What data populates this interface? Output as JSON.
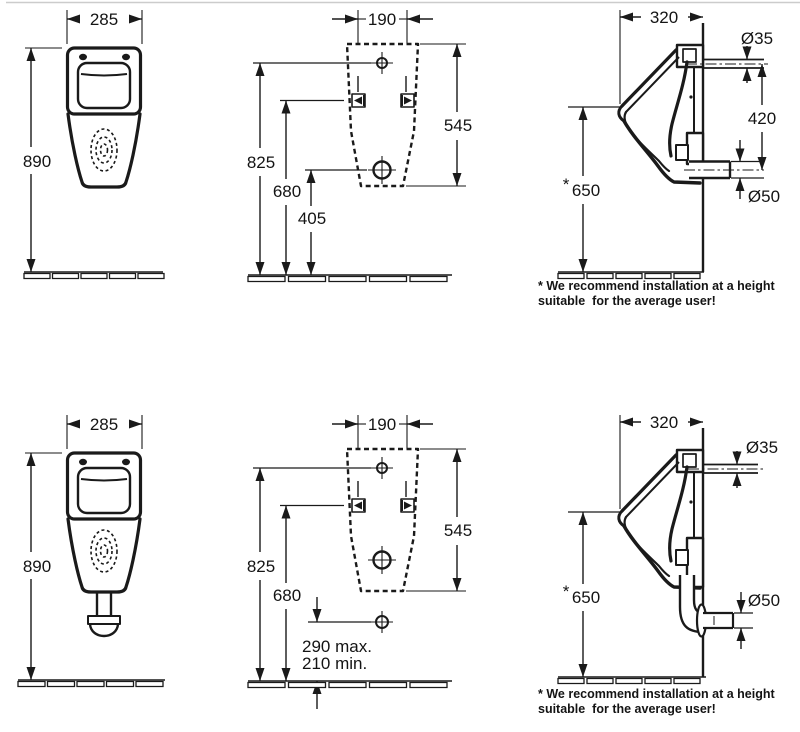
{
  "drawing_title": "urinal-installation-dimension-drawing",
  "colors": {
    "ink": "#1a1a1a",
    "paper": "#ffffff",
    "top_rule": "#cccccc"
  },
  "note": {
    "line1": "* We recommend installation at a height",
    "line2": "suitable  for the average user!"
  },
  "views": {
    "front_top": {
      "width": "285",
      "height": "890"
    },
    "back_top": {
      "width": "190",
      "outline_height": "545",
      "inlet_height": "825",
      "fixing_height": "680",
      "drain_height": "405"
    },
    "side_top": {
      "depth": "320",
      "inlet_diameter": "Ø35",
      "connection_spacing": "420",
      "outlet_diameter": "Ø50",
      "rim_height": "650",
      "footnote_marker": "*"
    },
    "front_bottom": {
      "width": "285",
      "height": "890"
    },
    "back_bottom": {
      "width": "190",
      "outline_height": "545",
      "inlet_height": "825",
      "fixing_height": "680",
      "outlet_height_max": "290 max.",
      "outlet_height_min": "210 min."
    },
    "side_bottom": {
      "depth": "320",
      "inlet_diameter": "Ø35",
      "outlet_diameter": "Ø50",
      "rim_height": "650",
      "footnote_marker": "*"
    }
  }
}
